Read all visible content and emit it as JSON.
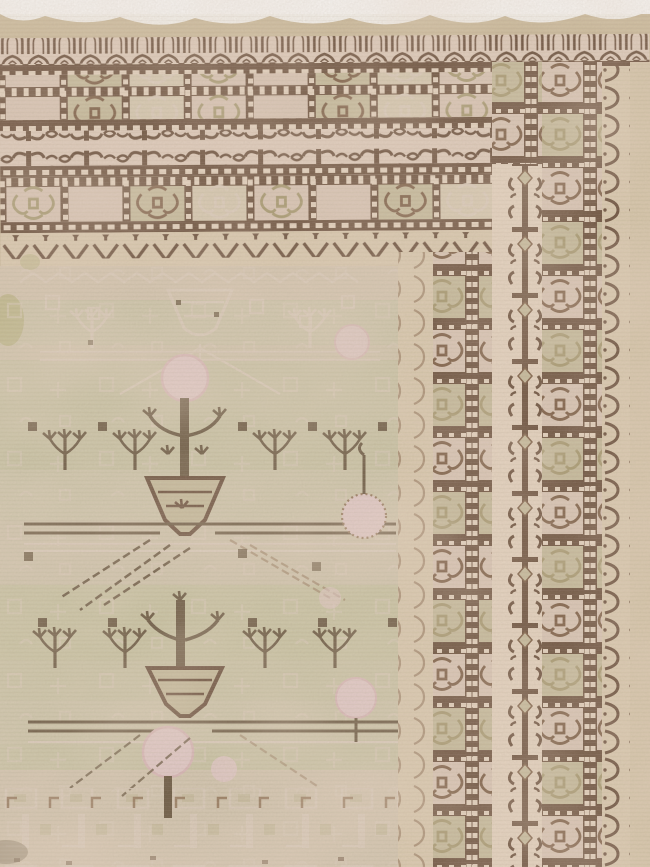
{
  "image": {
    "subject": "Antique Samarkand Khotan pomegranate rug, corner detail photograph",
    "type": "photograph",
    "background": "#ffffff"
  },
  "palette": {
    "photo-bg": "#ffffff",
    "selvage": "#cdbc9c",
    "border-ground": "#e4d0c2",
    "dash-cream": "#ead8c6",
    "cream": "#ddcdb2",
    "cream-2": "#d8c8ac",
    "box-pink": "#dcc8ba",
    "box-olive": "#c5bb9b",
    "box-cream": "#d9cdb5",
    "olive-dark": "#a09468",
    "brown-dark": "#553826",
    "brown": "#6b4a32",
    "brown-soft": "#8a6a4e",
    "field": "#ccc7a9",
    "field-2": "#d3ccb4",
    "field-pink": "#dac9b8",
    "ghost": "#ded0c1",
    "pink": "#e7cdd0",
    "pink-deep": "#dcb9be",
    "stem": "#5a4832",
    "olive-patch": "#b5b27b",
    "shadow": "#6f604a"
  },
  "rug": {
    "field": {
      "ground": "pale celadon green with rose abrash",
      "motifs": [
        "pomegranate-tree",
        "vase-pot",
        "sapling-row",
        "trellis-lattice",
        "pink-pomegranate-fruit"
      ]
    },
    "borders": [
      {
        "name": "outer-arch-guard",
        "motif": "pointed arches"
      },
      {
        "name": "box-border",
        "motif": "alternating plain and rosette squares"
      },
      {
        "name": "scroll-band",
        "motif": "paired rams-horn scrolls"
      },
      {
        "name": "inner-box-border",
        "motif": "ornamented squares"
      },
      {
        "name": "vandyke-guard",
        "motif": "zigzag chevron points"
      },
      {
        "name": "vine-meander",
        "motif": "hooked vine chain"
      },
      {
        "name": "outer-scallop-guard",
        "motif": "crescent hooks"
      }
    ]
  }
}
